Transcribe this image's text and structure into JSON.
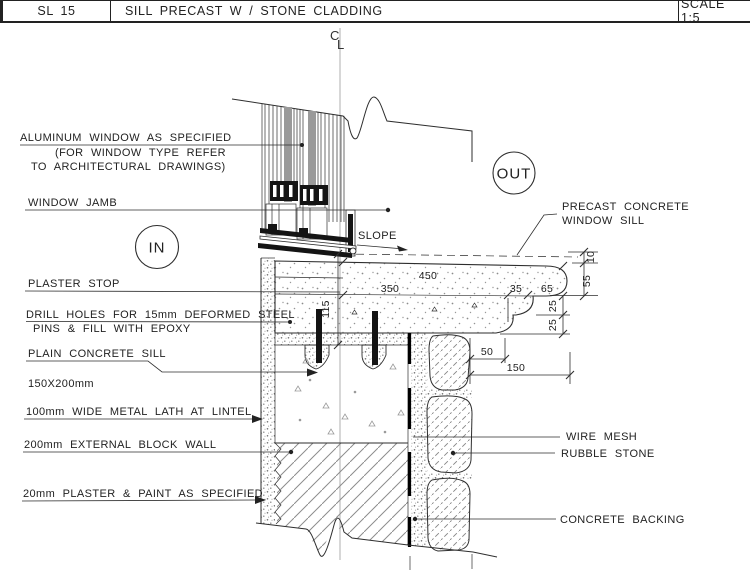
{
  "header": {
    "code": "SL 15",
    "title": "SILL PRECAST W / STONE CLADDING",
    "scale": "SCALE 1:5"
  },
  "annotations": {
    "aluminum_window_1": "ALUMINUM WINDOW AS SPECIFIED",
    "aluminum_window_2": "(FOR WINDOW TYPE REFER",
    "aluminum_window_3": "TO ARCHITECTURAL DRAWINGS)",
    "window_jamb": "WINDOW JAMB",
    "plaster_stop": "PLASTER STOP",
    "drill_holes_1": "DRILL HOLES FOR 15mm DEFORMED STEEL",
    "drill_holes_2": "PINS & FILL WITH EPOXY",
    "plain_sill_1": "PLAIN CONCRETE SILL",
    "plain_sill_2": "150X200mm",
    "metal_lath": "100mm WIDE METAL LATH AT LINTEL",
    "block_wall": "200mm EXTERNAL BLOCK WALL",
    "plaster_paint": "20mm PLASTER & PAINT AS SPECIFIED",
    "precast_1": "PRECAST CONCRETE",
    "precast_2": "WINDOW SILL",
    "wire_mesh": "WIRE MESH",
    "rubble_stone": "RUBBLE STONE",
    "concrete_backing": "CONCRETE BACKING",
    "slope": "SLOPE",
    "in_marker": "IN",
    "out_marker": "OUT",
    "cl_c": "C",
    "cl_l": "L"
  },
  "dimensions": {
    "d450": "450",
    "d350": "350",
    "d35": "35",
    "d65": "65",
    "d10": "10",
    "d55": "55",
    "d25a": "25",
    "d25b": "25",
    "d115": "115",
    "d50": "50",
    "d150": "150"
  },
  "colors": {
    "line": "#2e2e2e",
    "glazing_gray": "#9a9a9a",
    "pin_black": "#141414"
  }
}
